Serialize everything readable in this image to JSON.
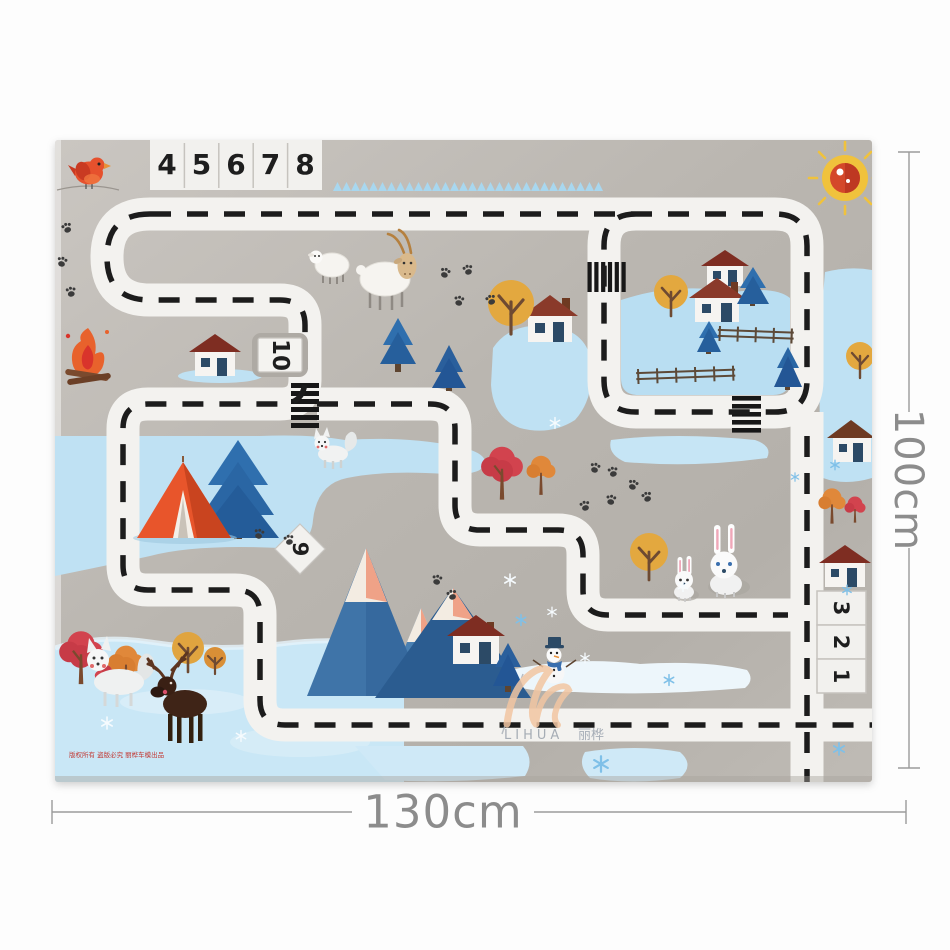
{
  "annotations": {
    "height_label": "100cm",
    "width_label": "130cm"
  },
  "mat": {
    "brand": {
      "latin": "LIHUA",
      "cjk": "丽桦"
    },
    "copyright_line": "版权所有 盗版必究 丽桦车模出品",
    "parking": {
      "top_row": [
        "4",
        "5",
        "6",
        "7",
        "8"
      ],
      "spot_a": "10",
      "spot_b": "9",
      "right_column": [
        "3",
        "2",
        "1"
      ]
    },
    "colors": {
      "mat_gray": "#bcb8b2",
      "road_white": "#f3f2ef",
      "dash_black": "#1c1c1c",
      "ice_blue": "#c9e7f6",
      "sky_blue": "#bfe1f3",
      "accent_orange": "#e8552b",
      "mountain_blue": "#3f74a8",
      "sun_yellow": "#f0c23c",
      "sun_red": "#d4482a"
    },
    "scene_icons": [
      "sun-icon",
      "bird-icon",
      "campfire-icon",
      "tent-icon",
      "pine-tree-icon",
      "round-tree-icon",
      "autumn-tree-icon",
      "mountain-icon",
      "snowman-icon",
      "sheep-icon",
      "goat-icon",
      "fox-icon",
      "moose-icon",
      "rabbit-icon",
      "house-icon",
      "fence-icon",
      "paw-prints-icon",
      "snowflake-icon",
      "crosswalk",
      "dashed-road"
    ]
  }
}
